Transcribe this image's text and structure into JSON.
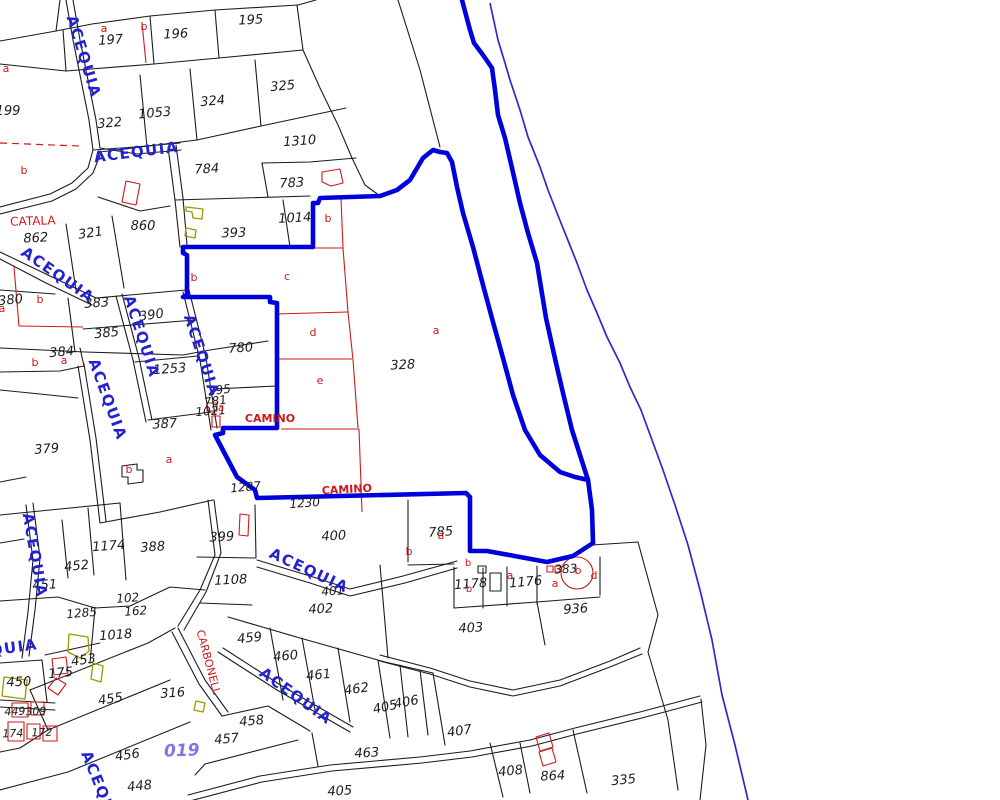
{
  "map": {
    "waterway_name": "ACEQUIA",
    "road_name": "CAMINO",
    "place_names": [
      "CATALA",
      "CARBONELL"
    ],
    "sheet_number": "019",
    "colors": {
      "boundary_blue": "#0000dd",
      "thin_line_blue": "#2b2bcc",
      "waterway_text_blue": "#2222cf",
      "annotation_red": "#cc1a1a",
      "sheet_violet": "#8a6fe8",
      "building_olive": "#9a9a00",
      "parcel_black": "#1c1c1c"
    }
  },
  "labels": [
    {
      "t": "197",
      "x": 111,
      "y": 44,
      "r": -4,
      "c": "k",
      "s": 13,
      "i": 1,
      "w": 0
    },
    {
      "t": "196",
      "x": 176,
      "y": 38,
      "r": -3,
      "c": "k",
      "s": 13,
      "i": 1,
      "w": 0
    },
    {
      "t": "195",
      "x": 251,
      "y": 24,
      "r": -3,
      "c": "k",
      "s": 13,
      "i": 1,
      "w": 0
    },
    {
      "t": "199",
      "x": 8,
      "y": 115,
      "r": 0,
      "c": "k",
      "s": 13,
      "i": 1,
      "w": 0
    },
    {
      "t": "322",
      "x": 110,
      "y": 127,
      "r": -5,
      "c": "k",
      "s": 13,
      "i": 1,
      "w": 0
    },
    {
      "t": "1053",
      "x": 155,
      "y": 117,
      "r": -5,
      "c": "k",
      "s": 13,
      "i": 1,
      "w": 0
    },
    {
      "t": "324",
      "x": 213,
      "y": 105,
      "r": -5,
      "c": "k",
      "s": 13,
      "i": 1,
      "w": 0
    },
    {
      "t": "325",
      "x": 283,
      "y": 90,
      "r": -5,
      "c": "k",
      "s": 13,
      "i": 1,
      "w": 0
    },
    {
      "t": "1310",
      "x": 300,
      "y": 145,
      "r": -4,
      "c": "k",
      "s": 13,
      "i": 1,
      "w": 0
    },
    {
      "t": "784",
      "x": 207,
      "y": 173,
      "r": -3,
      "c": "k",
      "s": 13,
      "i": 1,
      "w": 0
    },
    {
      "t": "783",
      "x": 292,
      "y": 187,
      "r": -3,
      "c": "k",
      "s": 13,
      "i": 1,
      "w": 0
    },
    {
      "t": "393",
      "x": 234,
      "y": 237,
      "r": -2,
      "c": "k",
      "s": 13,
      "i": 1,
      "w": 0
    },
    {
      "t": "1014",
      "x": 295,
      "y": 222,
      "r": -3,
      "c": "k",
      "s": 13,
      "i": 1,
      "w": 0
    },
    {
      "t": "862",
      "x": 36,
      "y": 242,
      "r": -3,
      "c": "k",
      "s": 13,
      "i": 1,
      "w": 0
    },
    {
      "t": "321",
      "x": 91,
      "y": 237,
      "r": -8,
      "c": "k",
      "s": 13,
      "i": 1,
      "w": 0
    },
    {
      "t": "860",
      "x": 143,
      "y": 230,
      "r": 0,
      "c": "k",
      "s": 13,
      "i": 1,
      "w": 0
    },
    {
      "t": "380",
      "x": 11,
      "y": 304,
      "r": -6,
      "c": "k",
      "s": 13,
      "i": 1,
      "w": 0
    },
    {
      "t": "383",
      "x": 97,
      "y": 307,
      "r": -4,
      "c": "k",
      "s": 13,
      "i": 1,
      "w": 0
    },
    {
      "t": "390",
      "x": 152,
      "y": 319,
      "r": -8,
      "c": "k",
      "s": 13,
      "i": 1,
      "w": 0
    },
    {
      "t": "385",
      "x": 107,
      "y": 337,
      "r": -6,
      "c": "k",
      "s": 13,
      "i": 1,
      "w": 0
    },
    {
      "t": "384",
      "x": 62,
      "y": 356,
      "r": -5,
      "c": "k",
      "s": 13,
      "i": 1,
      "w": 0
    },
    {
      "t": "1253",
      "x": 170,
      "y": 373,
      "r": -4,
      "c": "k",
      "s": 13,
      "i": 1,
      "w": 0
    },
    {
      "t": "780",
      "x": 241,
      "y": 352,
      "r": -4,
      "c": "k",
      "s": 13,
      "i": 1,
      "w": 0
    },
    {
      "t": "395",
      "x": 220,
      "y": 394,
      "r": -8,
      "c": "k",
      "s": 12,
      "i": 1,
      "w": 0
    },
    {
      "t": "781",
      "x": 216,
      "y": 405,
      "r": -8,
      "c": "k",
      "s": 12,
      "i": 1,
      "w": 0
    },
    {
      "t": "1021",
      "x": 211,
      "y": 415,
      "r": -4,
      "c": "k",
      "s": 12,
      "i": 1,
      "w": 0
    },
    {
      "t": "387",
      "x": 165,
      "y": 428,
      "r": -3,
      "c": "k",
      "s": 13,
      "i": 1,
      "w": 0
    },
    {
      "t": "328",
      "x": 403,
      "y": 369,
      "r": -3,
      "c": "k",
      "s": 13,
      "i": 1,
      "w": 0
    },
    {
      "t": "379",
      "x": 47,
      "y": 453,
      "r": -4,
      "c": "k",
      "s": 13,
      "i": 1,
      "w": 0
    },
    {
      "t": "1287",
      "x": 246,
      "y": 491,
      "r": -5,
      "c": "k",
      "s": 12,
      "i": 1,
      "w": 0
    },
    {
      "t": "1230",
      "x": 305,
      "y": 507,
      "r": -4,
      "c": "k",
      "s": 12,
      "i": 1,
      "w": 0
    },
    {
      "t": "400",
      "x": 334,
      "y": 540,
      "r": -3,
      "c": "k",
      "s": 13,
      "i": 1,
      "w": 0
    },
    {
      "t": "399",
      "x": 222,
      "y": 541,
      "r": -3,
      "c": "k",
      "s": 13,
      "i": 1,
      "w": 0
    },
    {
      "t": "1108",
      "x": 231,
      "y": 584,
      "r": -3,
      "c": "k",
      "s": 13,
      "i": 1,
      "w": 0
    },
    {
      "t": "1174",
      "x": 109,
      "y": 550,
      "r": -4,
      "c": "k",
      "s": 13,
      "i": 1,
      "w": 0
    },
    {
      "t": "388",
      "x": 153,
      "y": 551,
      "r": -4,
      "c": "k",
      "s": 13,
      "i": 1,
      "w": 0
    },
    {
      "t": "452",
      "x": 77,
      "y": 570,
      "r": -6,
      "c": "k",
      "s": 13,
      "i": 1,
      "w": 0
    },
    {
      "t": "451",
      "x": 45,
      "y": 589,
      "r": -4,
      "c": "k",
      "s": 13,
      "i": 1,
      "w": 0
    },
    {
      "t": "785",
      "x": 441,
      "y": 536,
      "r": -4,
      "c": "k",
      "s": 13,
      "i": 1,
      "w": 0
    },
    {
      "t": "1178",
      "x": 471,
      "y": 588,
      "r": -4,
      "c": "k",
      "s": 13,
      "i": 1,
      "w": 0
    },
    {
      "t": "1176",
      "x": 526,
      "y": 586,
      "r": -5,
      "c": "k",
      "s": 13,
      "i": 1,
      "w": 0
    },
    {
      "t": "383",
      "x": 566,
      "y": 573,
      "r": -3,
      "c": "k",
      "s": 12,
      "i": 1,
      "w": 0
    },
    {
      "t": "936",
      "x": 576,
      "y": 613,
      "r": -4,
      "c": "k",
      "s": 13,
      "i": 1,
      "w": 0
    },
    {
      "t": "403",
      "x": 471,
      "y": 632,
      "r": -3,
      "c": "k",
      "s": 13,
      "i": 1,
      "w": 0
    },
    {
      "t": "401",
      "x": 333,
      "y": 595,
      "r": -4,
      "c": "k",
      "s": 12,
      "i": 1,
      "w": 0
    },
    {
      "t": "402",
      "x": 321,
      "y": 613,
      "r": -3,
      "c": "k",
      "s": 13,
      "i": 1,
      "w": 0
    },
    {
      "t": "1285",
      "x": 82,
      "y": 617,
      "r": -5,
      "c": "k",
      "s": 12,
      "i": 1,
      "w": 0
    },
    {
      "t": "102",
      "x": 128,
      "y": 602,
      "r": -4,
      "c": "k",
      "s": 12,
      "i": 1,
      "w": 0
    },
    {
      "t": "162",
      "x": 136,
      "y": 615,
      "r": -4,
      "c": "k",
      "s": 12,
      "i": 1,
      "w": 0
    },
    {
      "t": "1018",
      "x": 116,
      "y": 639,
      "r": -4,
      "c": "k",
      "s": 13,
      "i": 1,
      "w": 0
    },
    {
      "t": "453",
      "x": 84,
      "y": 664,
      "r": -8,
      "c": "k",
      "s": 13,
      "i": 1,
      "w": 0
    },
    {
      "t": "175",
      "x": 61,
      "y": 677,
      "r": -6,
      "c": "k",
      "s": 13,
      "i": 1,
      "w": 0
    },
    {
      "t": "450",
      "x": 19,
      "y": 686,
      "r": -2,
      "c": "k",
      "s": 13,
      "i": 1,
      "w": 0
    },
    {
      "t": "455",
      "x": 111,
      "y": 703,
      "r": -8,
      "c": "k",
      "s": 13,
      "i": 1,
      "w": 0
    },
    {
      "t": "316",
      "x": 173,
      "y": 697,
      "r": -4,
      "c": "k",
      "s": 13,
      "i": 1,
      "w": 0
    },
    {
      "t": "459",
      "x": 250,
      "y": 642,
      "r": -6,
      "c": "k",
      "s": 13,
      "i": 1,
      "w": 0
    },
    {
      "t": "460",
      "x": 286,
      "y": 660,
      "r": -5,
      "c": "k",
      "s": 13,
      "i": 1,
      "w": 0
    },
    {
      "t": "461",
      "x": 319,
      "y": 679,
      "r": -6,
      "c": "k",
      "s": 13,
      "i": 1,
      "w": 0
    },
    {
      "t": "462",
      "x": 357,
      "y": 693,
      "r": -8,
      "c": "k",
      "s": 13,
      "i": 1,
      "w": 0
    },
    {
      "t": "405",
      "x": 386,
      "y": 711,
      "r": -12,
      "c": "k",
      "s": 13,
      "i": 1,
      "w": 0
    },
    {
      "t": "406",
      "x": 407,
      "y": 706,
      "r": -10,
      "c": "k",
      "s": 13,
      "i": 1,
      "w": 0
    },
    {
      "t": "407",
      "x": 460,
      "y": 735,
      "r": -8,
      "c": "k",
      "s": 13,
      "i": 1,
      "w": 0
    },
    {
      "t": "458",
      "x": 252,
      "y": 725,
      "r": -5,
      "c": "k",
      "s": 13,
      "i": 1,
      "w": 0
    },
    {
      "t": "457",
      "x": 227,
      "y": 743,
      "r": -5,
      "c": "k",
      "s": 13,
      "i": 1,
      "w": 0
    },
    {
      "t": "463",
      "x": 367,
      "y": 757,
      "r": -3,
      "c": "k",
      "s": 13,
      "i": 1,
      "w": 0
    },
    {
      "t": "408",
      "x": 511,
      "y": 775,
      "r": -6,
      "c": "k",
      "s": 13,
      "i": 1,
      "w": 0
    },
    {
      "t": "864",
      "x": 553,
      "y": 780,
      "r": -3,
      "c": "k",
      "s": 13,
      "i": 1,
      "w": 0
    },
    {
      "t": "335",
      "x": 624,
      "y": 784,
      "r": -6,
      "c": "k",
      "s": 13,
      "i": 1,
      "w": 0
    },
    {
      "t": "448",
      "x": 140,
      "y": 790,
      "r": -6,
      "c": "k",
      "s": 13,
      "i": 1,
      "w": 0
    },
    {
      "t": "405",
      "x": 340,
      "y": 795,
      "r": -3,
      "c": "k",
      "s": 13,
      "i": 1,
      "w": 0
    },
    {
      "t": "449",
      "x": 15,
      "y": 715,
      "r": -2,
      "c": "k",
      "s": 11,
      "i": 1,
      "w": 0
    },
    {
      "t": "309",
      "x": 36,
      "y": 715,
      "r": -2,
      "c": "k",
      "s": 11,
      "i": 1,
      "w": 0
    },
    {
      "t": "174",
      "x": 13,
      "y": 737,
      "r": -2,
      "c": "k",
      "s": 11,
      "i": 1,
      "w": 0
    },
    {
      "t": "172",
      "x": 42,
      "y": 736,
      "r": -2,
      "c": "k",
      "s": 11,
      "i": 1,
      "w": 0
    },
    {
      "t": "456",
      "x": 128,
      "y": 759,
      "r": -8,
      "c": "k",
      "s": 13,
      "i": 1,
      "w": 0
    },
    {
      "t": "a",
      "x": 6,
      "y": 72,
      "r": 0,
      "c": "r",
      "s": 11,
      "i": 0,
      "w": 0
    },
    {
      "t": "b",
      "x": 24,
      "y": 174,
      "r": 0,
      "c": "r",
      "s": 11,
      "i": 0,
      "w": 0
    },
    {
      "t": "a",
      "x": 104,
      "y": 32,
      "r": 0,
      "c": "r",
      "s": 11,
      "i": 0,
      "w": 0
    },
    {
      "t": "b",
      "x": 144,
      "y": 30,
      "r": 0,
      "c": "r",
      "s": 11,
      "i": 0,
      "w": 0
    },
    {
      "t": "a",
      "x": 2,
      "y": 312,
      "r": 0,
      "c": "r",
      "s": 11,
      "i": 0,
      "w": 0
    },
    {
      "t": "b",
      "x": 40,
      "y": 303,
      "r": 0,
      "c": "r",
      "s": 11,
      "i": 0,
      "w": 0
    },
    {
      "t": "b",
      "x": 35,
      "y": 366,
      "r": 0,
      "c": "r",
      "s": 11,
      "i": 0,
      "w": 0
    },
    {
      "t": "a",
      "x": 64,
      "y": 364,
      "r": 0,
      "c": "r",
      "s": 11,
      "i": 0,
      "w": 0
    },
    {
      "t": "b",
      "x": 194,
      "y": 281,
      "r": 0,
      "c": "r",
      "s": 11,
      "i": 0,
      "w": 0
    },
    {
      "t": "c",
      "x": 287,
      "y": 280,
      "r": 0,
      "c": "r",
      "s": 11,
      "i": 0,
      "w": 0
    },
    {
      "t": "b",
      "x": 328,
      "y": 222,
      "r": 0,
      "c": "r",
      "s": 11,
      "i": 0,
      "w": 0
    },
    {
      "t": "d",
      "x": 313,
      "y": 336,
      "r": 0,
      "c": "r",
      "s": 11,
      "i": 0,
      "w": 0
    },
    {
      "t": "e",
      "x": 320,
      "y": 384,
      "r": 0,
      "c": "r",
      "s": 11,
      "i": 0,
      "w": 0
    },
    {
      "t": "a",
      "x": 436,
      "y": 334,
      "r": 0,
      "c": "r",
      "s": 11,
      "i": 0,
      "w": 0
    },
    {
      "t": "a",
      "x": 169,
      "y": 463,
      "r": 0,
      "c": "r",
      "s": 11,
      "i": 0,
      "w": 0
    },
    {
      "t": "b",
      "x": 129,
      "y": 473,
      "r": 0,
      "c": "r",
      "s": 11,
      "i": 0,
      "w": 0
    },
    {
      "t": "a",
      "x": 221,
      "y": 411,
      "r": 0,
      "c": "r",
      "s": 10,
      "i": 0,
      "w": 0
    },
    {
      "t": "a",
      "x": 441,
      "y": 539,
      "r": 0,
      "c": "r",
      "s": 11,
      "i": 0,
      "w": 0
    },
    {
      "t": "b",
      "x": 409,
      "y": 555,
      "r": 0,
      "c": "r",
      "s": 11,
      "i": 0,
      "w": 0
    },
    {
      "t": "b",
      "x": 468,
      "y": 566,
      "r": 0,
      "c": "r",
      "s": 10,
      "i": 0,
      "w": 0
    },
    {
      "t": "b",
      "x": 469,
      "y": 592,
      "r": 0,
      "c": "r",
      "s": 10,
      "i": 0,
      "w": 0
    },
    {
      "t": "a",
      "x": 510,
      "y": 579,
      "r": 0,
      "c": "r",
      "s": 11,
      "i": 0,
      "w": 0
    },
    {
      "t": "a",
      "x": 555,
      "y": 587,
      "r": 0,
      "c": "r",
      "s": 11,
      "i": 0,
      "w": 0
    },
    {
      "t": "b",
      "x": 578,
      "y": 574,
      "r": 0,
      "c": "r",
      "s": 11,
      "i": 0,
      "w": 0
    },
    {
      "t": "d",
      "x": 594,
      "y": 579,
      "r": 0,
      "c": "r",
      "s": 11,
      "i": 0,
      "w": 0
    },
    {
      "t": "ACEQUIA",
      "x": 79,
      "y": 58,
      "r": 73,
      "c": "b",
      "s": 15,
      "i": 0,
      "w": 1
    },
    {
      "t": "ACEQUIA",
      "x": 137,
      "y": 157,
      "r": -7,
      "c": "b",
      "s": 15,
      "i": 0,
      "w": 1
    },
    {
      "t": "ACEQUIA",
      "x": 55,
      "y": 279,
      "r": 35,
      "c": "b",
      "s": 15,
      "i": 0,
      "w": 1
    },
    {
      "t": "ACEQUIA",
      "x": 137,
      "y": 338,
      "r": 72,
      "c": "b",
      "s": 15,
      "i": 0,
      "w": 1
    },
    {
      "t": "ACEQUIA",
      "x": 197,
      "y": 357,
      "r": 72,
      "c": "b",
      "s": 15,
      "i": 0,
      "w": 1
    },
    {
      "t": "ACEQUIA",
      "x": 103,
      "y": 401,
      "r": 70,
      "c": "b",
      "s": 15,
      "i": 0,
      "w": 1
    },
    {
      "t": "ACEQUIA",
      "x": 30,
      "y": 556,
      "r": 80,
      "c": "b",
      "s": 15,
      "i": 0,
      "w": 1
    },
    {
      "t": "ACEQUIA",
      "x": 307,
      "y": 575,
      "r": 25,
      "c": "b",
      "s": 15,
      "i": 0,
      "w": 1
    },
    {
      "t": "ACEQUIA",
      "x": 293,
      "y": 700,
      "r": 36,
      "c": "b",
      "s": 15,
      "i": 0,
      "w": 1
    },
    {
      "t": "ACEQUIA",
      "x": -4,
      "y": 655,
      "r": -8,
      "c": "b",
      "s": 15,
      "i": 0,
      "w": 1
    },
    {
      "t": "ACEQUIA",
      "x": 97,
      "y": 793,
      "r": 68,
      "c": "b",
      "s": 15,
      "i": 0,
      "w": 1
    },
    {
      "t": "CATALA",
      "x": 33,
      "y": 225,
      "r": -2,
      "c": "r",
      "s": 12,
      "i": 0,
      "w": 0
    },
    {
      "t": "CAMINO",
      "x": 270,
      "y": 422,
      "r": 0,
      "c": "r",
      "s": 11,
      "i": 0,
      "w": 1
    },
    {
      "t": "CAMINO",
      "x": 347,
      "y": 493,
      "r": -3,
      "c": "r",
      "s": 11,
      "i": 0,
      "w": 1
    },
    {
      "t": "CARBONELL",
      "x": 205,
      "y": 663,
      "r": 75,
      "c": "r",
      "s": 11,
      "i": 0,
      "w": 0
    },
    {
      "t": "019",
      "x": 182,
      "y": 756,
      "r": -2,
      "c": "v",
      "s": 17,
      "i": 1,
      "w": 1
    }
  ]
}
